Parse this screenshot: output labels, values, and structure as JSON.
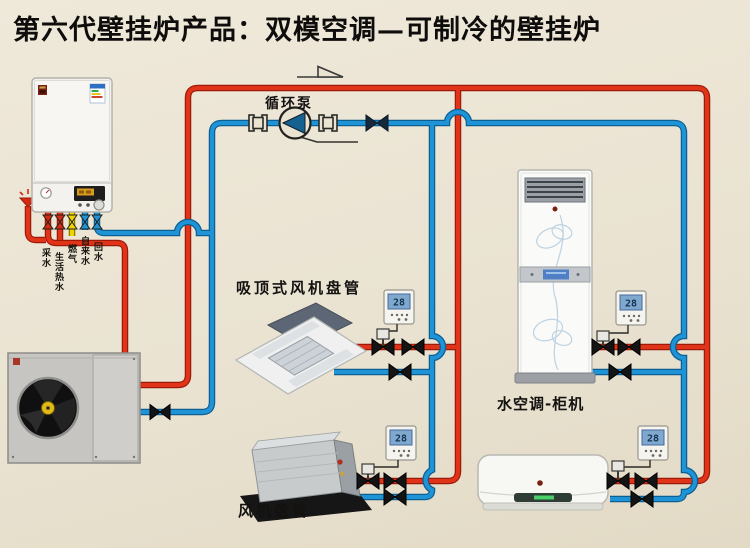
{
  "title": "第六代壁挂炉产品：双模空调—可制冷的壁挂炉",
  "labels": {
    "pump": "循环泵",
    "cassette_unit": "吸顶式风机盘管",
    "ducted_unit": "风机盘管",
    "cabinet_unit": "水空调-柜机"
  },
  "boiler": {
    "pipe_labels": [
      "采水",
      "生活热水",
      "燃气",
      "自来水",
      "回水"
    ]
  },
  "thermostat": {
    "reading": "28"
  },
  "colors": {
    "hot_pipe": "#d42a12",
    "cold_pipe": "#1787cc",
    "gas_pipe": "#efd400",
    "background": "#eae3d2"
  }
}
